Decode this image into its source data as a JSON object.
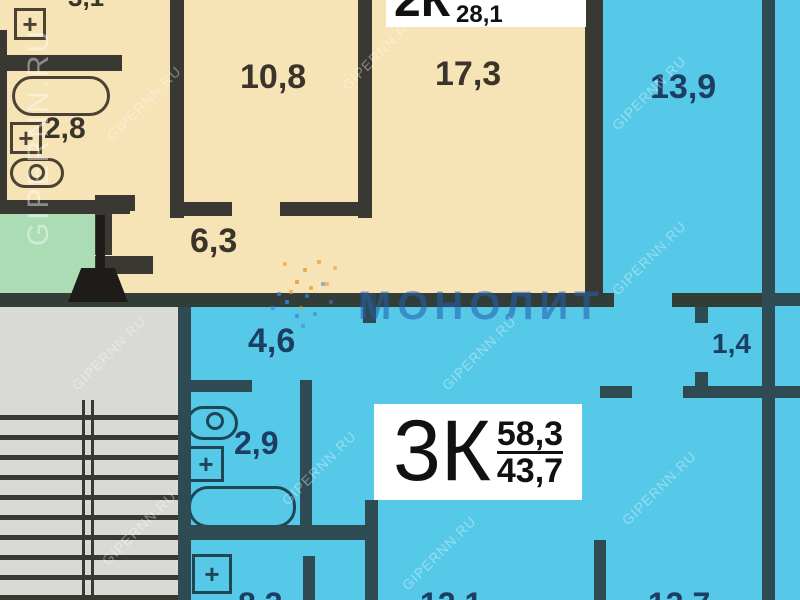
{
  "apartments": {
    "two_room": {
      "name": "2К",
      "total_area": "",
      "living_area": "28,1"
    },
    "three_room": {
      "name": "3К",
      "total_area": "58,3",
      "living_area": "43,7"
    }
  },
  "rooms": {
    "bath_2k": {
      "label": "2,8"
    },
    "room_10_8": {
      "label": "10,8"
    },
    "room_17_3": {
      "label": "17,3"
    },
    "room_13_9": {
      "label": "13,9"
    },
    "hall_6_3": {
      "label": "6,3"
    },
    "corridor_4_6": {
      "label": "4,6"
    },
    "bath_3k": {
      "label": "2,9"
    },
    "closet_1_4": {
      "label": "1,4"
    }
  },
  "partial_labels": {
    "top": "3,1",
    "bottom_left": "8,3",
    "bottom_middle": "12,1",
    "bottom_right": "13,7"
  },
  "watermark": {
    "site": "GIPERNN.RU",
    "brand": "МОНОЛИТ"
  },
  "icons": {
    "sink_cross": "+"
  },
  "colors": {
    "cream_room": "#f6e3b6",
    "cyan_room": "#56c8e8",
    "wall_dark": "#3a3832",
    "wall_teal": "#2e4a52",
    "stair_landing_green": "#abdcb4",
    "stairs_gray": "#d9d9d5",
    "label_navy": "#1c3e63",
    "label_brown": "#3b342a",
    "brand_blue": "#2e64ad"
  }
}
